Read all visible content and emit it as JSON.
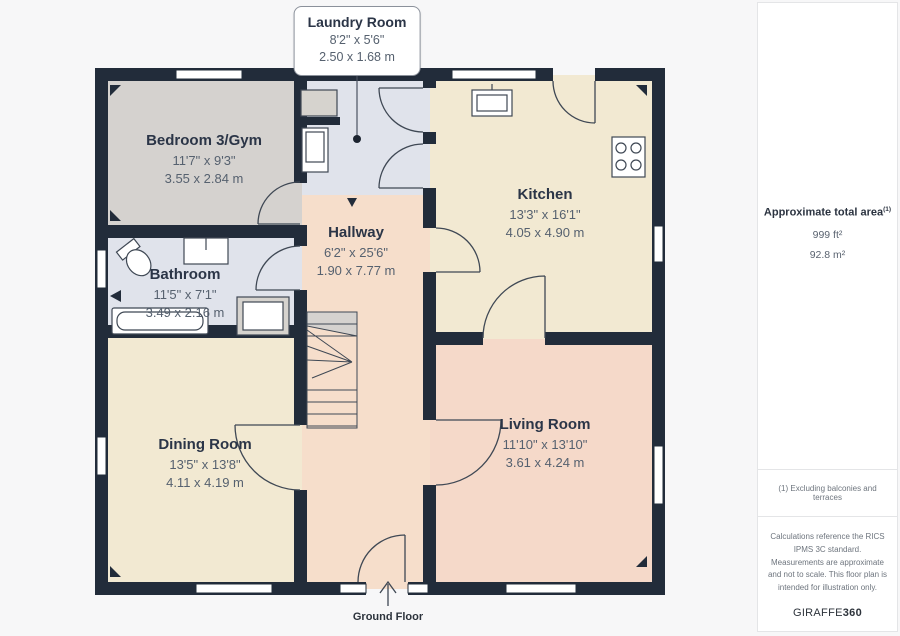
{
  "floor_label": "Ground Floor",
  "callout": {
    "title": "Laundry Room",
    "imperial": "8'2\" x 5'6\"",
    "metric": "2.50 x 1.68 m"
  },
  "rooms": {
    "bedroom": {
      "name": "Bedroom 3/Gym",
      "imperial": "11'7\" x 9'3\"",
      "metric": "3.55 x 2.84 m"
    },
    "bathroom": {
      "name": "Bathroom",
      "imperial": "11'5\" x 7'1\"",
      "metric": "3.49 x 2.16 m"
    },
    "hallway": {
      "name": "Hallway",
      "imperial": "6'2\" x 25'6\"",
      "metric": "1.90 x 7.77 m"
    },
    "kitchen": {
      "name": "Kitchen",
      "imperial": "13'3\" x 16'1\"",
      "metric": "4.05 x 4.90 m"
    },
    "dining": {
      "name": "Dining Room",
      "imperial": "13'5\" x 13'8\"",
      "metric": "4.11 x 4.19 m"
    },
    "living": {
      "name": "Living Room",
      "imperial": "11'10\" x 13'10\"",
      "metric": "3.61 x 4.24 m"
    }
  },
  "sidebar": {
    "area_title": "Approximate total area",
    "area_footnote_marker": "(1)",
    "area_ft": "999 ft²",
    "area_m": "92.8 m²",
    "footnote": "(1) Excluding balconies and terraces",
    "disclaimer": "Calculations reference the RICS IPMS 3C standard. Measurements are approximate and not to scale. This floor plan is intended for illustration only.",
    "brand_normal": "GIRAFFE",
    "brand_bold": "360"
  },
  "colors": {
    "pageBg": "#f7f7f8",
    "panelBg": "#ffffff",
    "wall": "#222c3a",
    "lineCol": "#3f4854",
    "roomGray": "#d5d2cf",
    "roomBlue": "#e0e3eb",
    "roomCream": "#f2e9d2",
    "roomPeach": "#f6decb",
    "roomPink": "#f5d9c9",
    "textDark": "#2b3547",
    "textDim": "#56616f"
  }
}
